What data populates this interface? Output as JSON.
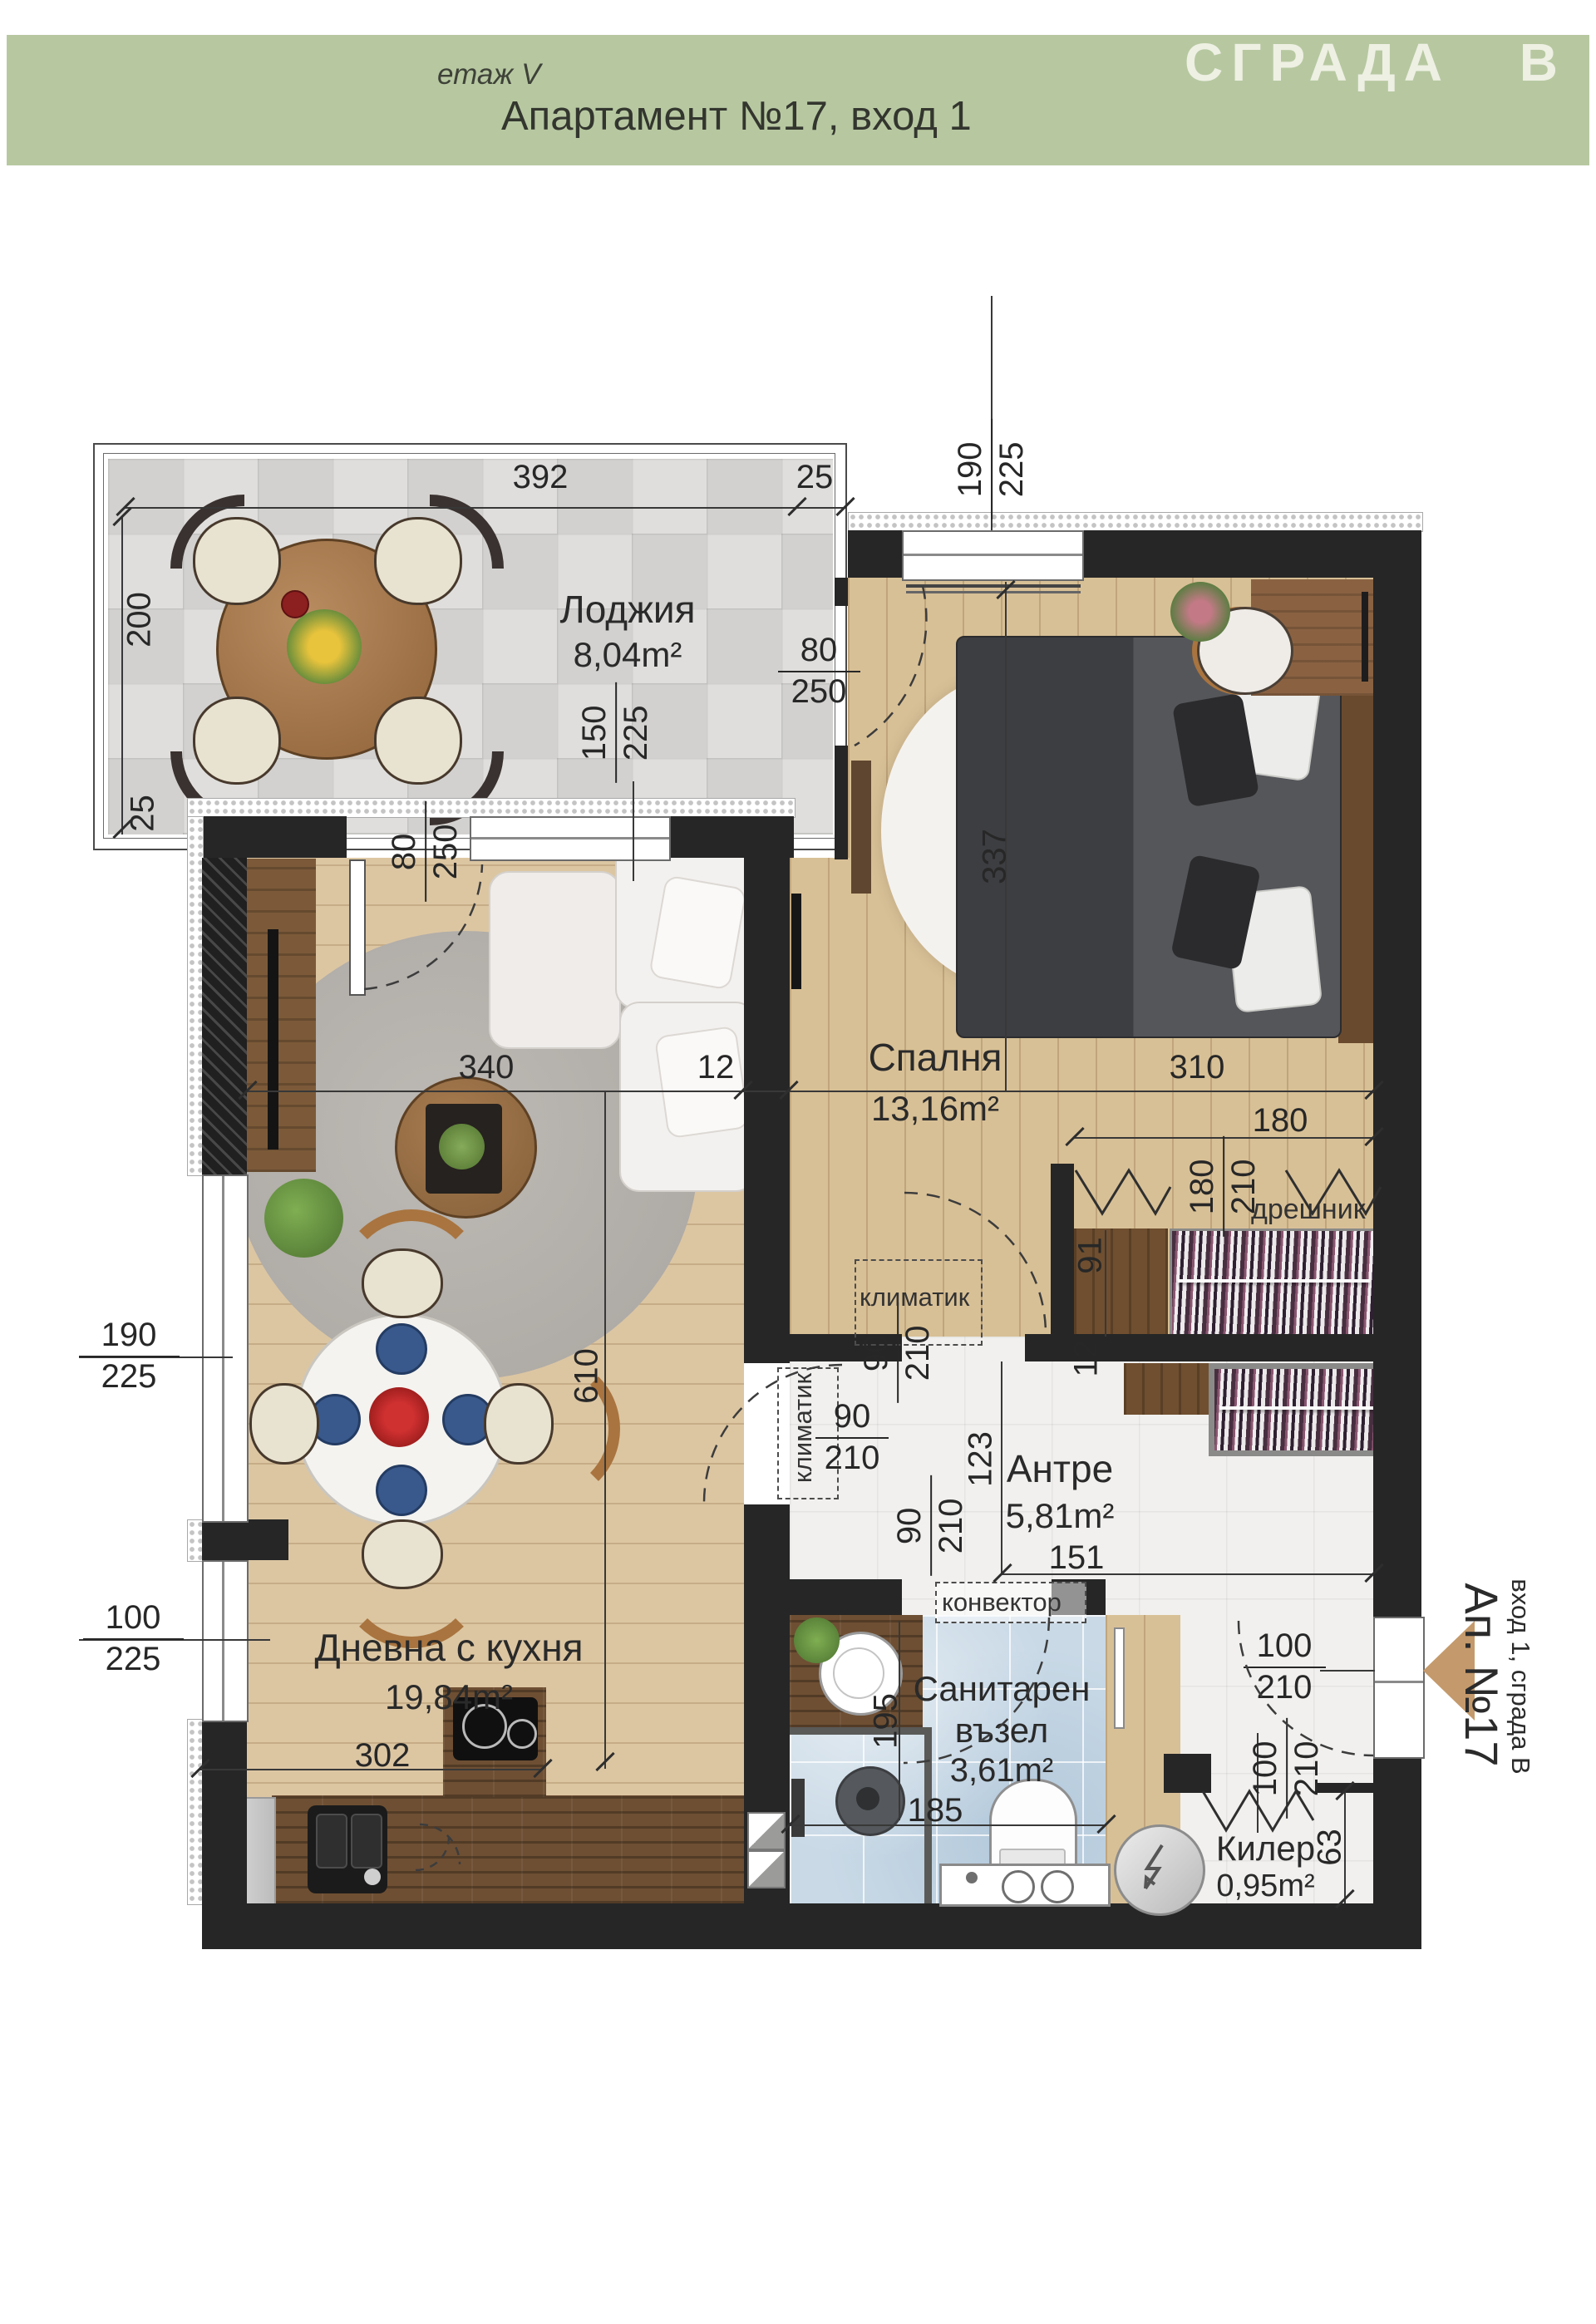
{
  "header": {
    "floor_label": "етаж V",
    "title": "Апартамент №17, вход 1",
    "building": "СГРАДА В"
  },
  "entrance_marker": {
    "apartment": "Ап. №17",
    "entrance": "вход 1, сграда В"
  },
  "rooms": {
    "loggia": {
      "name": "Лоджия",
      "area": "8,04m²"
    },
    "bedroom": {
      "name": "Спалня",
      "area": "13,16m²"
    },
    "living": {
      "name": "Дневна с кухня",
      "area": "19,84m²"
    },
    "hallway": {
      "name": "Антре",
      "area": "5,81m²"
    },
    "bathroom": {
      "name_line1": "Санитарен",
      "name_line2": "възел",
      "area": "3,61m²"
    },
    "closet": {
      "name": "Килер",
      "area": "0,95m²"
    },
    "wardrobe_label": "дрешник"
  },
  "equipment": {
    "ac": "климатик",
    "convector": "конвектор"
  },
  "dims": {
    "n392": "392",
    "n25": "25",
    "n200": "200",
    "n190": "190",
    "n225": "225",
    "n80": "80",
    "n250": "250",
    "n150": "150",
    "n340": "340",
    "n12": "12",
    "n310": "310",
    "n337": "337",
    "n180": "180",
    "n210": "210",
    "n91": "91",
    "n90": "90",
    "n123": "123",
    "n151": "151",
    "n610": "610",
    "n100": "100",
    "n302": "302",
    "n185": "185",
    "n195": "195",
    "n63": "63"
  },
  "colors": {
    "header_bg": "#b7c8a1",
    "wall": "#262626",
    "wood_light": "#d9c29c",
    "wood_dark": "#6e4f33",
    "tile_blue": "#c9d9e6",
    "accent_arrow": "#c49a6c"
  }
}
